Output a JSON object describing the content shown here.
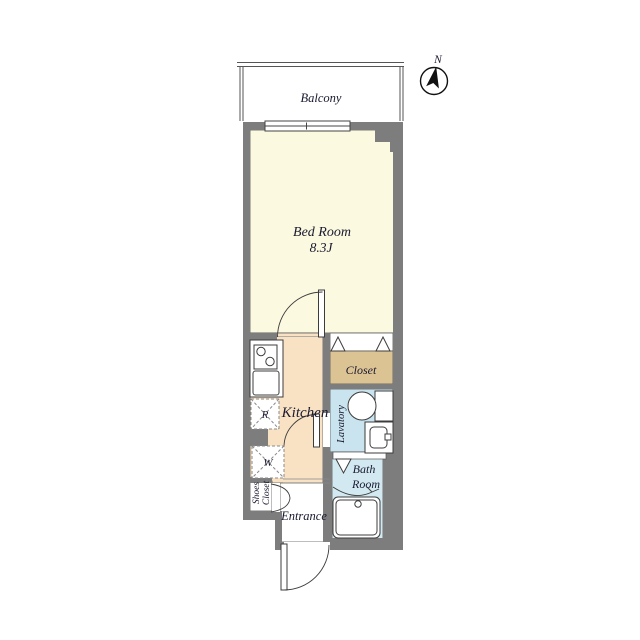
{
  "plan": {
    "title": "apartment-floor-plan",
    "compass": {
      "label": "N"
    },
    "balcony": {
      "label": "Balcony"
    },
    "rooms": {
      "bedroom": {
        "name": "Bed Room",
        "size": "8.3J"
      },
      "kitchen": {
        "name": "Kitchen"
      },
      "closet": {
        "name": "Closet"
      },
      "lavatory": {
        "name": "Lavatory"
      },
      "bathroom": {
        "lines": [
          "Bath",
          "Room"
        ]
      },
      "entrance": {
        "name": "Entrance"
      },
      "shoes_closet": {
        "lines": [
          "Shoes",
          "Closet"
        ]
      }
    },
    "appliances": {
      "refrigerator": "R",
      "washer": "W"
    },
    "colors": {
      "wall": "#7d7d7d",
      "bedroom_floor": "#FCF9E1",
      "kitchen_floor": "#F9E2C4",
      "closet_floor": "#DCC394",
      "lavatory_floor": "#C9E4EE",
      "bath_floor": "#D2E9F1",
      "fixture": "#FFFFFF",
      "line": "#3E3E3E",
      "text": "#1A1A30"
    }
  }
}
